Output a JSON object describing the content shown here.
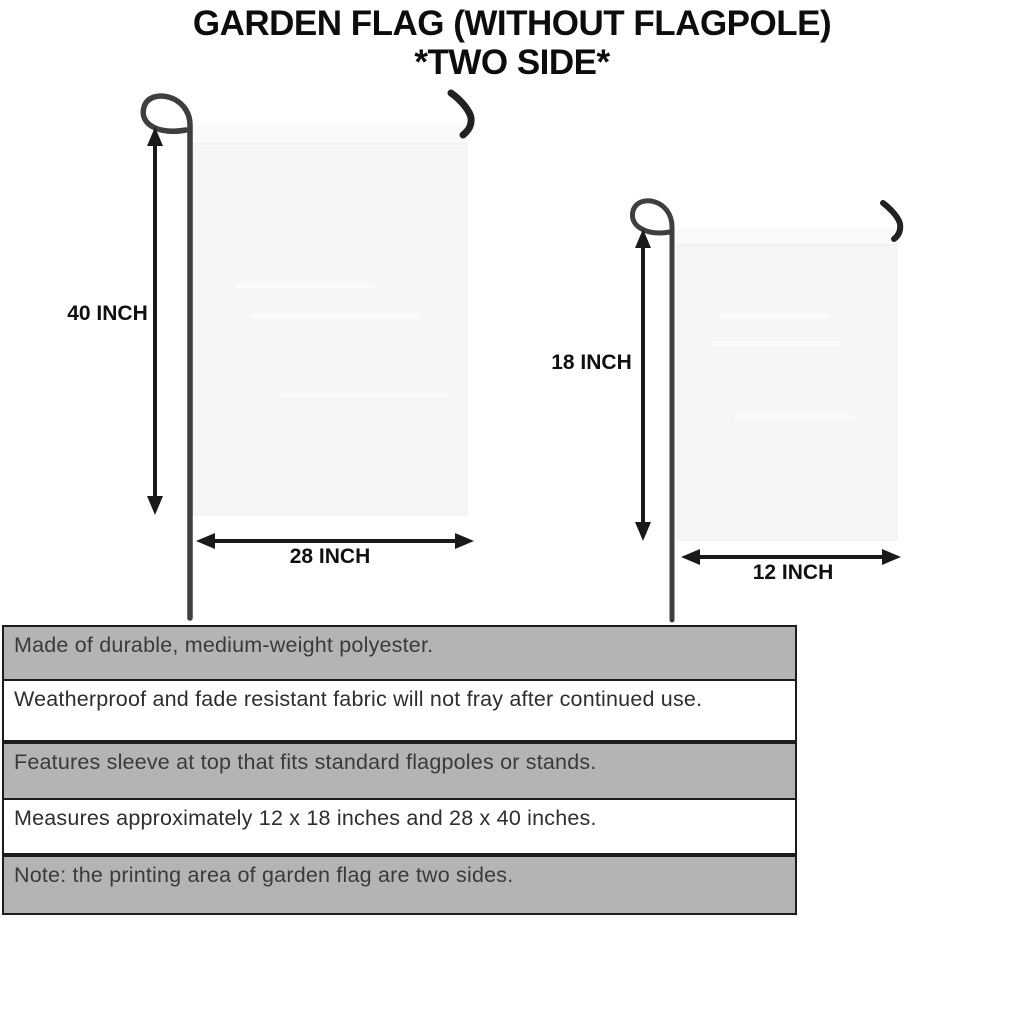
{
  "title": {
    "line1": "GARDEN FLAG (WITHOUT FLAGPOLE)",
    "line2": "*TWO SIDE*"
  },
  "flags": {
    "large": {
      "height_label": "40 INCH",
      "width_label": "28 INCH"
    },
    "small": {
      "height_label": "18 INCH",
      "width_label": "12 INCH"
    }
  },
  "features": [
    {
      "text": "Made of durable, medium-weight polyester.",
      "shaded": true
    },
    {
      "text": "Weatherproof and fade resistant fabric will not fray after continued use.",
      "shaded": false
    },
    {
      "text": "Features sleeve at top that fits standard flagpoles or stands.",
      "shaded": true
    },
    {
      "text": "Measures approximately 12 x 18 inches and 28 x 40 inches.",
      "shaded": false
    },
    {
      "text": "Note: the printing area of garden flag are two sides.",
      "shaded": true
    }
  ],
  "colors": {
    "ink": "#0d0d0d",
    "bar_gray": "#b4b4b4",
    "bar_border": "#1c1c1c",
    "bar_text": "#3a3a3a",
    "flag_fill": "#f6f6f6",
    "pole_color": "#3f3f3f",
    "arrow_color": "#1a1a1a"
  }
}
